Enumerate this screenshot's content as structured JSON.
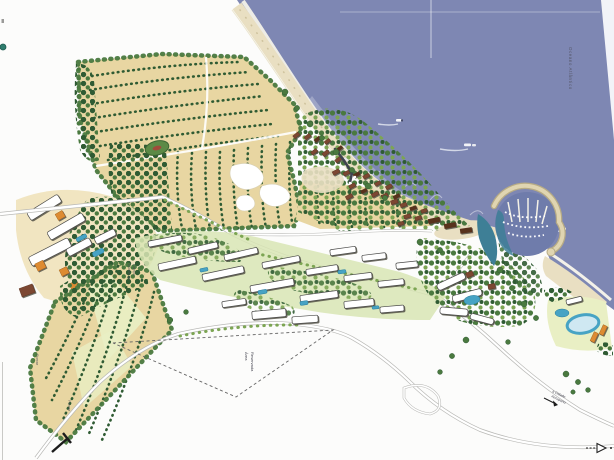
{
  "labels": {
    "ocean": "Oceano Atlântico",
    "reserved_area": {
      "line1": "Área",
      "line2": "Reservada"
    },
    "field_upper": "Pomar",
    "field_lower": "Pomar",
    "nucleo": {
      "line1": "Núcleo de",
      "line2": "Campo"
    },
    "road_exit": {
      "line1": "a Cidade",
      "line2": "Aeroporto"
    }
  },
  "icons": {
    "direction_arrow": "right-arrow",
    "entrance_marker": "site-entrance"
  },
  "palette": {
    "paper": "#fcfcfb",
    "sea": "#7e87b3",
    "surf-white": "#f3f1e9",
    "beach-sand": "#e9dfc2",
    "breakwater": "#e0d5b1",
    "field-tan": "#e8d6a2",
    "field-light": "#efe2ba",
    "lawn": "#d8e5b4",
    "lawn-pale": "#e9efc4",
    "tree-dark": "#2f5b33",
    "tree-mid": "#4a793f",
    "tree-light": "#7ca553",
    "roof-red": "#7c4630",
    "roof-dark": "#58321f",
    "bld-stroke": "#4a4a48",
    "pool-blue": "#47a3c4",
    "teal-water": "#3e7f96",
    "marina-water": "#6f7cab",
    "road-casing": "#b9b9b6",
    "road-fill": "#ffffff",
    "dash-gray": "#666666",
    "orange": "#dd8b33",
    "label-ink": "#4a4a55",
    "page-line": "#c9c9c6"
  }
}
